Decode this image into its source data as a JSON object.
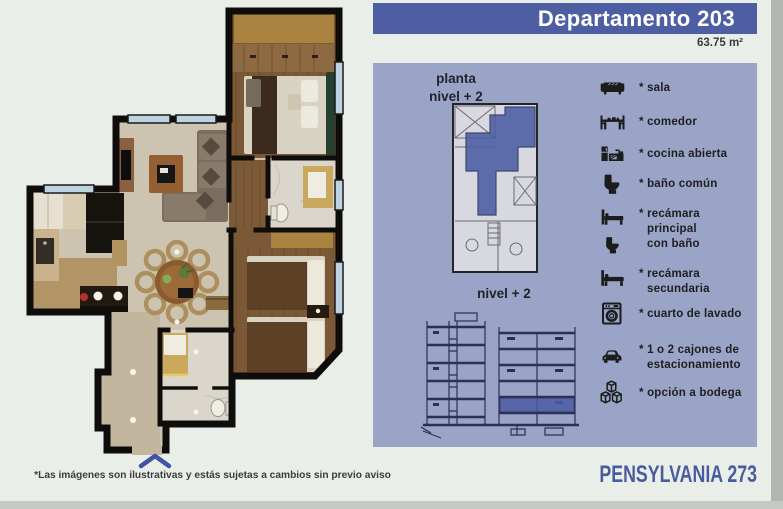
{
  "header": {
    "title": "Departamento 203",
    "area": "63.75 m²"
  },
  "panel": {
    "planta_label": "planta\nnivel + 2",
    "nivel_label": "nivel + 2",
    "legend": [
      {
        "icon": "sofa-icon",
        "label": "* sala"
      },
      {
        "icon": "dining-table-icon",
        "label": "* comedor"
      },
      {
        "icon": "kitchen-icon",
        "label": "* cocina abierta"
      },
      {
        "icon": "toilet-icon",
        "label": "* baño común"
      },
      {
        "icon": "bed-with-bath-icon",
        "label": "* recámara\nprincipal\ncon baño"
      },
      {
        "icon": "bed-icon",
        "label": "* recámara\nsecundaria"
      },
      {
        "icon": "washing-machine-icon",
        "label": "* cuarto de lavado"
      },
      {
        "icon": "car-icon",
        "label": "* 1 o 2 cajones de\nestacionamiento"
      },
      {
        "icon": "storage-boxes-icon",
        "label": "* opción a bodega"
      }
    ]
  },
  "footer": {
    "disclaimer": "*Las imágenes son ilustrativas y estás sujetas a cambios sin previo aviso",
    "brand": "PENSYLVANIA 273"
  },
  "colors": {
    "banner_bg": "#4e5ea2",
    "panel_bg": "#99a4c7",
    "unit_highlight": "#4c5ca3",
    "page_bg": "#eaeee9",
    "brand_text": "#4a5ca0",
    "legend_ink": "#1c1c1c"
  }
}
